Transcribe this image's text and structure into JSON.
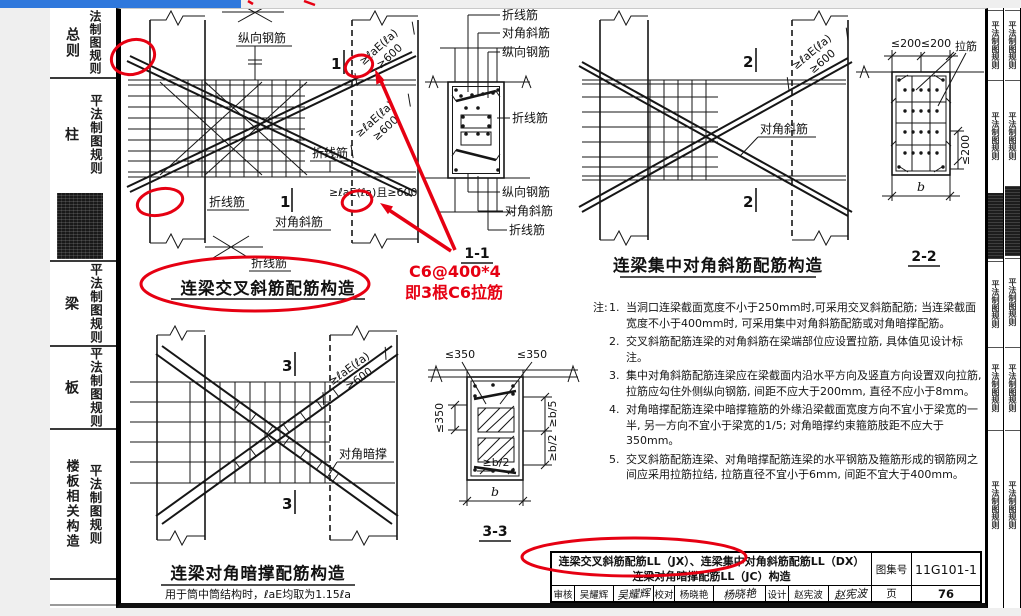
{
  "colors": {
    "top_bar_blue": "#2f78dc",
    "annotation_red": "#e60012"
  },
  "left_sidebar": {
    "tabs": [
      {
        "main": "总则",
        "sub": "法制图规则"
      },
      {
        "main": "柱",
        "sub": "平法制图规则"
      },
      {
        "main": "梁",
        "sub": "平法制图规则"
      },
      {
        "main": "板",
        "sub": "平法制图规则"
      },
      {
        "main": "楼板相关构造",
        "sub": "平法制图规则"
      }
    ]
  },
  "right_tabs": {
    "label": "平法制图规则"
  },
  "page": {
    "dims": {
      "anchor": "≥ℓaE(ℓa)",
      "min600": "≥600",
      "anchor_and": "≥ℓaE(ℓa)且≥600",
      "le200": "≤200",
      "le350": "≤350",
      "ge_b5": "≥b/5",
      "ge_b2": "≥b/2",
      "b": "b"
    },
    "figures": {
      "jx": {
        "title": "连梁交叉斜筋配筋构造",
        "marker": "1",
        "section": "1-1",
        "labels": {
          "longitudinal": "纵向钢筋",
          "folded": "折线筋",
          "diagonal": "对角斜筋"
        }
      },
      "dx": {
        "title": "连梁集中对角斜筋配筋构造",
        "marker": "2",
        "section": "2-2",
        "labels": {
          "diagonal": "对角斜筋",
          "tie": "拉筋"
        }
      },
      "jc": {
        "title": "连梁对角暗撑配筋构造",
        "subtitle": "用于筒中筒结构时，ℓaE均取为1.15ℓa",
        "marker": "3",
        "section": "3-3",
        "labels": {
          "brace": "对角暗撑"
        }
      }
    },
    "notes": {
      "prefix": "注:",
      "items": [
        {
          "num": "1.",
          "text": "当洞口连梁截面宽度不小于250mm时,可采用交叉斜筋配筋; 当连梁截面宽度不小于400mm时, 可采用集中对角斜筋配筋或对角暗撑配筋。"
        },
        {
          "num": "2.",
          "text": "交叉斜筋配筋连梁的对角斜筋在梁端部位应设置拉筋, 具体值见设计标注。"
        },
        {
          "num": "3.",
          "text": "集中对角斜筋配筋连梁应在梁截面内沿水平方向及竖直方向设置双向拉筋, 拉筋应勾住外侧纵向钢筋, 间距不应大于200mm, 直径不应小于8mm。"
        },
        {
          "num": "4.",
          "text": "对角暗撑配筋连梁中暗撑箍筋的外缘沿梁截面宽度方向不宜小于梁宽的一半, 另一方向不宜小于梁宽的1/5; 对角暗撑约束箍筋肢距不应大于350mm。"
        },
        {
          "num": "5.",
          "text": "交叉斜筋配筋连梁、对角暗撑配筋连梁的水平钢筋及箍筋形成的钢筋网之间应采用拉筋拉结, 拉筋直径不宜小于6mm, 间距不宜大于400mm。"
        }
      ]
    },
    "title_block": {
      "title_line1": "连梁交叉斜筋配筋LL（JX）、连梁集中对角斜筋配筋LL（DX）",
      "title_line2": "连梁对角暗撑配筋LL（JC）构造",
      "atlas_label": "图集号",
      "atlas_no": "11G101-1",
      "page_label": "页",
      "page_no": "76",
      "review_label": "审核",
      "reviewer": "吴耀辉",
      "reviewer_sig": "吴耀辉",
      "check_label": "校对",
      "checker": "杨晓艳",
      "checker_sig": "杨晓艳",
      "design_label": "设计",
      "designer": "赵宪波",
      "designer_sig": "赵宪波"
    },
    "annotations": {
      "note_line1": "C6@400*4",
      "note_line2": "即3根C6拉筋"
    }
  }
}
